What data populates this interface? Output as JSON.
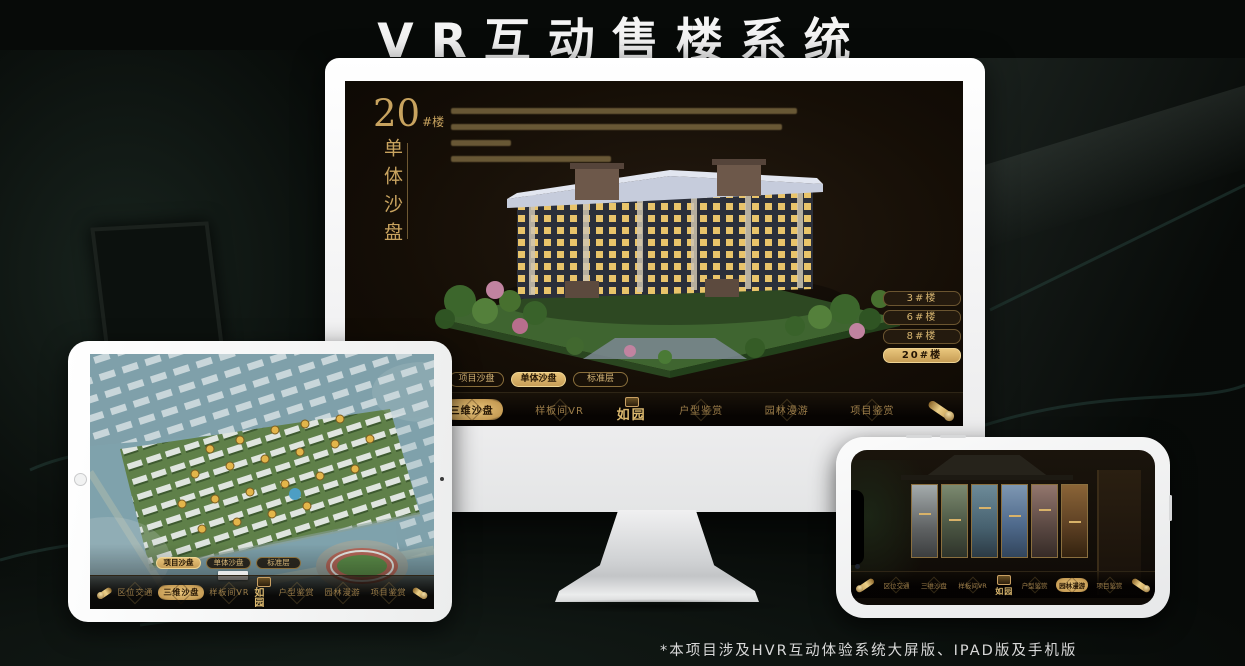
{
  "page": {
    "title": "VR互动售楼系统",
    "footnote": "*本项目涉及HVR互动体验系统大屏版、IPAD版及手机版"
  },
  "colors": {
    "gold": "#c9a063",
    "gold_bright": "#e8c378",
    "screen_bg": "#17100a",
    "title_white": "#f4f4f4"
  },
  "desktop": {
    "heading": {
      "number": "20",
      "unit": "#楼",
      "subtitle": "单体沙盘"
    },
    "paragraph_line_widths": [
      93,
      89,
      16,
      43
    ],
    "floor_buttons": [
      {
        "label": "3#楼",
        "active": false
      },
      {
        "label": "6#楼",
        "active": false
      },
      {
        "label": "8#楼",
        "active": false
      },
      {
        "label": "20#楼",
        "active": true
      }
    ],
    "tabs": [
      {
        "label": "项目沙盘",
        "active": false
      },
      {
        "label": "单体沙盘",
        "active": true
      },
      {
        "label": "标准层",
        "active": false
      }
    ],
    "menu": {
      "logo": "如园",
      "items": [
        {
          "label": "区位交通",
          "active": false
        },
        {
          "label": "三维沙盘",
          "active": true
        },
        {
          "label": "样板间VR",
          "active": false
        },
        {
          "label": "户型鉴赏",
          "active": false
        },
        {
          "label": "园林漫游",
          "active": false
        },
        {
          "label": "项目鉴赏",
          "active": false
        }
      ]
    }
  },
  "tablet": {
    "tabs": [
      {
        "label": "项目沙盘",
        "active": true
      },
      {
        "label": "单体沙盘",
        "active": false
      },
      {
        "label": "标准层",
        "active": false
      }
    ],
    "menu": {
      "logo": "如园",
      "items": [
        {
          "label": "区位交通",
          "active": false
        },
        {
          "label": "三维沙盘",
          "active": true
        },
        {
          "label": "样板间VR",
          "active": false
        },
        {
          "label": "户型鉴赏",
          "active": false
        },
        {
          "label": "园林漫游",
          "active": false
        },
        {
          "label": "项目鉴赏",
          "active": false
        }
      ]
    }
  },
  "phone": {
    "menu": {
      "logo": "如园",
      "items": [
        {
          "label": "区位交通",
          "active": false
        },
        {
          "label": "三维沙盘",
          "active": false
        },
        {
          "label": "样板间VR",
          "active": false
        },
        {
          "label": "户型鉴赏",
          "active": false
        },
        {
          "label": "园林漫游",
          "active": true
        },
        {
          "label": "项目鉴赏",
          "active": false
        }
      ]
    },
    "gallery_panel_count": 6
  }
}
